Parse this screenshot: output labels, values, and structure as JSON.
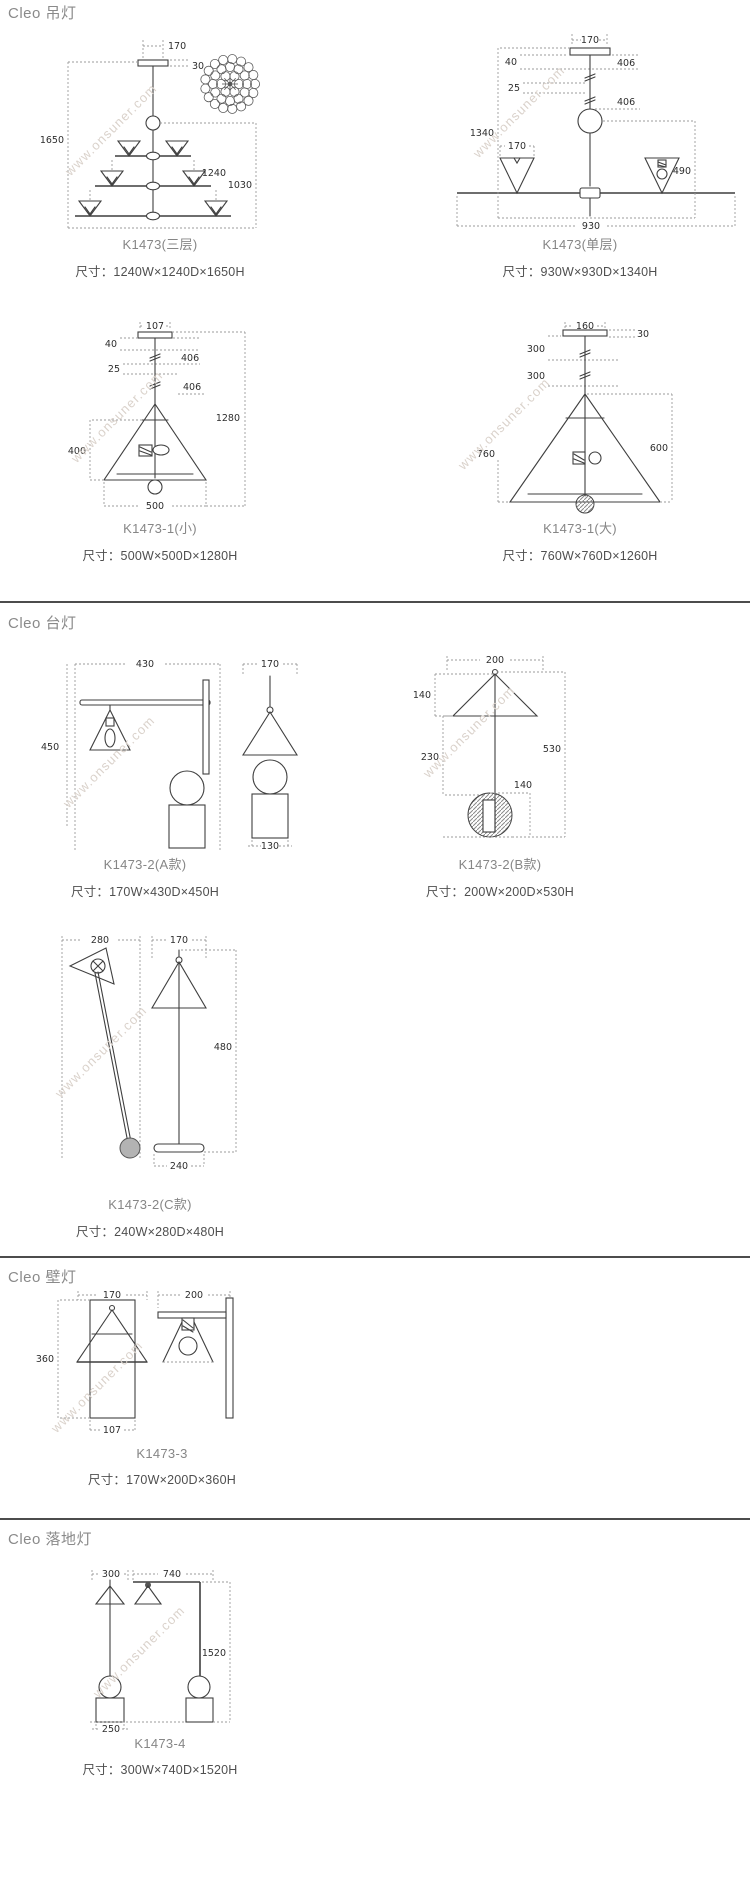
{
  "watermark": "www.onsuner.com",
  "sections": [
    {
      "title": "Cleo 吊灯",
      "products": [
        {
          "name": "K1473(三层)",
          "size": "尺寸：1240W×1240D×1650H",
          "dims": {
            "top_w": "170",
            "canopy_h": "30",
            "total_h": "1650",
            "width": "1240",
            "body_h": "1030"
          }
        },
        {
          "name": "K1473(单层)",
          "size": "尺寸：930W×930D×1340H",
          "dims": {
            "top_w": "170",
            "canopy_h": "40",
            "gap": "25",
            "rod_a": "406",
            "rod_b": "406",
            "total_h": "1340",
            "shade_w": "170",
            "body_h": "490",
            "width": "930"
          }
        },
        {
          "name": "K1473-1(小)",
          "size": "尺寸：500W×500D×1280H",
          "dims": {
            "top_w": "107",
            "canopy_h": "40",
            "gap": "25",
            "rod_a": "406",
            "rod_b": "406",
            "shade_h": "400",
            "total_h": "1280",
            "shade_w": "500"
          }
        },
        {
          "name": "K1473-1(大)",
          "size": "尺寸：760W×760D×1260H",
          "dims": {
            "top_w": "160",
            "canopy_h": "30",
            "rod_a": "300",
            "rod_b": "300",
            "shade_w": "760",
            "shade_h": "600"
          }
        }
      ]
    },
    {
      "title": "Cleo 台灯",
      "products": [
        {
          "name": "K1473-2(A款)",
          "size": "尺寸：170W×430D×450H",
          "dims": {
            "depth": "430",
            "width": "170",
            "height": "450",
            "base_w": "130"
          }
        },
        {
          "name": "K1473-2(B款)",
          "size": "尺寸：200W×200D×530H",
          "dims": {
            "top_w": "200",
            "shade_h": "140",
            "stem_h": "230",
            "total_h": "530",
            "base_h": "140"
          }
        },
        {
          "name": "K1473-2(C款)",
          "size": "尺寸：240W×280D×480H",
          "dims": {
            "depth": "280",
            "width": "170",
            "height": "480",
            "base_w": "240"
          }
        }
      ]
    },
    {
      "title": "Cleo 壁灯",
      "products": [
        {
          "name": "K1473-3",
          "size": "尺寸：170W×200D×360H",
          "dims": {
            "width": "170",
            "depth": "200",
            "height": "360",
            "base_w": "107"
          }
        }
      ]
    },
    {
      "title": "Cleo 落地灯",
      "products": [
        {
          "name": "K1473-4",
          "size": "尺寸：300W×740D×1520H",
          "dims": {
            "shade_w": "300",
            "depth": "740",
            "total_h": "1520",
            "base_w": "250"
          }
        }
      ]
    }
  ]
}
